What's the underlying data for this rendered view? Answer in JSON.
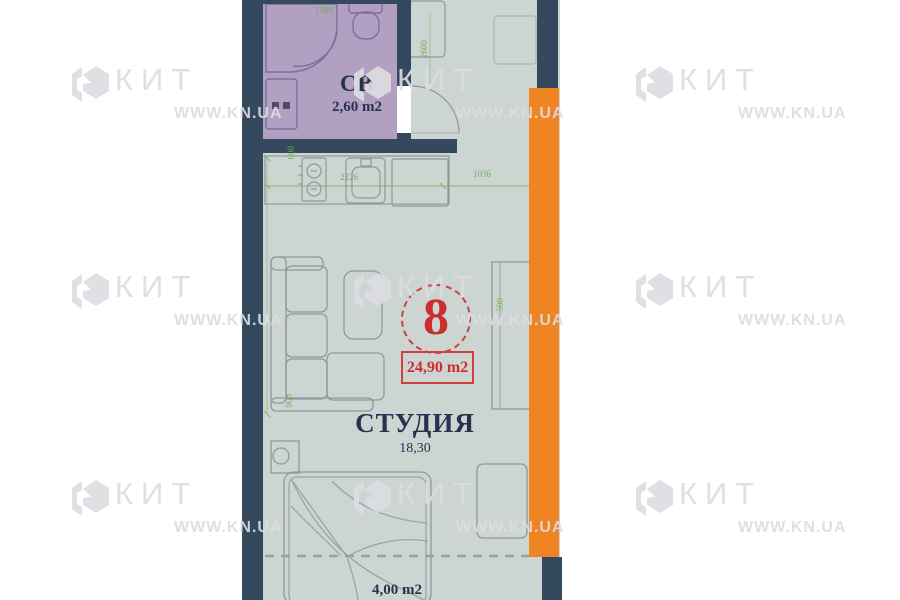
{
  "watermark": {
    "brand": "КИТ",
    "site": "WWW.KN.UA"
  },
  "unit": {
    "number": "8",
    "total_area": "24,90 m2"
  },
  "rooms": {
    "studio": {
      "name": "СТУДИЯ",
      "area": "18,30"
    },
    "bathroom": {
      "name": "СВ",
      "area": "2,60 m2"
    },
    "balcony": {
      "area": "4,00 m2"
    }
  },
  "dimensions": {
    "bath_width": "1586",
    "entry": "2600",
    "kitchen_left": "2226",
    "kitchen_right": "1036",
    "kitchen_depth": "600",
    "sofa": "900",
    "wardrobe": "500"
  },
  "colors": {
    "wall": "#35495e",
    "balcony_strip": "#ef8522",
    "floor": "#cdd5d2",
    "bathroom_fill": "#b2a0c2",
    "dimension_green": "#6fae52",
    "accent_red": "#cd3632",
    "text_navy": "#25334e"
  }
}
